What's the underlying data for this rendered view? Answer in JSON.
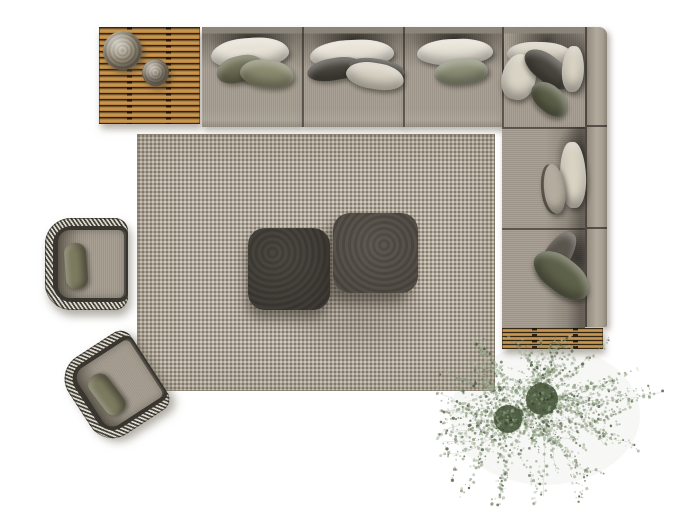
{
  "scene": {
    "type": "3d-furniture-render-top-view",
    "description": "Top-down render of a lounge set: L-shaped sectional sofa with scatter pillows, slatted teak bench with two knitted poufs, slatted teak platform, area rug, two charcoal square coffee tables, two woven armchairs with olive pillows, and a wispy potted plant",
    "items": [
      {
        "name": "slatted-wood-bench",
        "position": "top-left",
        "poufs": 2
      },
      {
        "name": "sectional-sofa",
        "layout": "L-shape",
        "top_row_sections": 4,
        "right_column_sections": 2,
        "scatter_pillows": 16
      },
      {
        "name": "slatted-wood-platform",
        "position": "right-bottom"
      },
      {
        "name": "area-rug",
        "pattern": "fine dotted weave"
      },
      {
        "name": "coffee-table-small",
        "shape": "rounded square"
      },
      {
        "name": "coffee-table-large",
        "shape": "rounded square"
      },
      {
        "name": "woven-armchair",
        "position": "left-top",
        "pillow": "olive"
      },
      {
        "name": "woven-armchair",
        "position": "left-bottom",
        "pillow": "olive",
        "rotation_deg": -33
      },
      {
        "name": "potted-plant",
        "pots": 2,
        "foliage": "wispy"
      }
    ],
    "colors": {
      "bg": "#ffffff",
      "sofaFabric": "#a49c8f",
      "sofaFabricLight": "#b2aa9c",
      "backrestTop": "#8d877b",
      "pillowWhite": "#e7e2d6",
      "pillowCream": "#d9d3c4",
      "pillowOlive": "#8c8b6f",
      "pillowOliveDark": "#6e6d54",
      "pillowOliveDeep": "#5e6149",
      "pillowSage": "#8e9178",
      "pillowCharcoal": "#4a463f",
      "pillowTaupeDark": "#5b564d",
      "pillowGray": "#b4ad9f",
      "wood": "#b5823f",
      "woodDark": "#2f2514",
      "woodLight": "#d8ab63",
      "rugBase": "#b3aa9b",
      "tableSmall": "#46423c",
      "tableLarge": "#57524a",
      "tableEdge": "#2c2925",
      "weaveLight": "#ded9cd",
      "weaveDark": "#44413b",
      "chairCushion": "#a49c8f",
      "chairPillow": "#7c7a5f",
      "chairGap": "#39352f",
      "poufLarge": "#b1a895",
      "poufSmall": "#a59c8b",
      "plantFoliage": "#87987a",
      "plantFoliage2": "#a6b499",
      "plantDark": "#47563b",
      "plantStem": "#76866a"
    }
  }
}
